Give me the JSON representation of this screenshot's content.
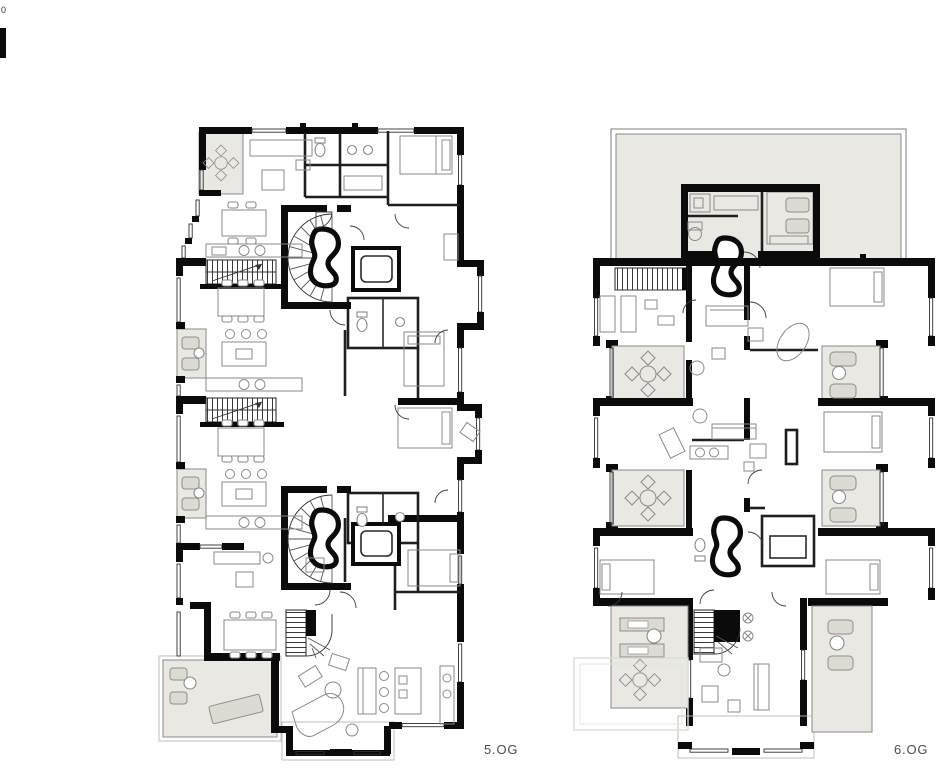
{
  "drawing": {
    "type": "architectural-floor-plans",
    "sheet_background": "#ffffff",
    "plans": [
      {
        "id": "plan-5og",
        "label": "5.OG",
        "position": "left",
        "features": [
          "three stacked apartments plus penthouse living level",
          "two kidney-shaped stair cores with elevators",
          "straight hatched stairs",
          "corner balcony top-left",
          "two west loggias",
          "large south-west terrace",
          "grand piano in lower living room"
        ]
      },
      {
        "id": "plan-6og",
        "label": "6.OG",
        "position": "right",
        "features": [
          "large roof terrace at top",
          "penthouse volume with kidney stair",
          "two west loggias and two east loggias",
          "central living halls",
          "bottom wing with switchback stair",
          "flanking roof terraces",
          "faint roof outline lower left"
        ]
      }
    ],
    "scale_mark": {
      "zero_label": "0"
    },
    "colors": {
      "wall": "#0b0b0b",
      "terrace_fill": "#e9e8e3",
      "terrace_furniture": "#dcdbd3",
      "furniture_stroke": "#8a8a8a",
      "window_line": "#2f2f2f",
      "label_text": "#4b4b4b",
      "faint_roof_line": "#dcdcd6"
    }
  }
}
